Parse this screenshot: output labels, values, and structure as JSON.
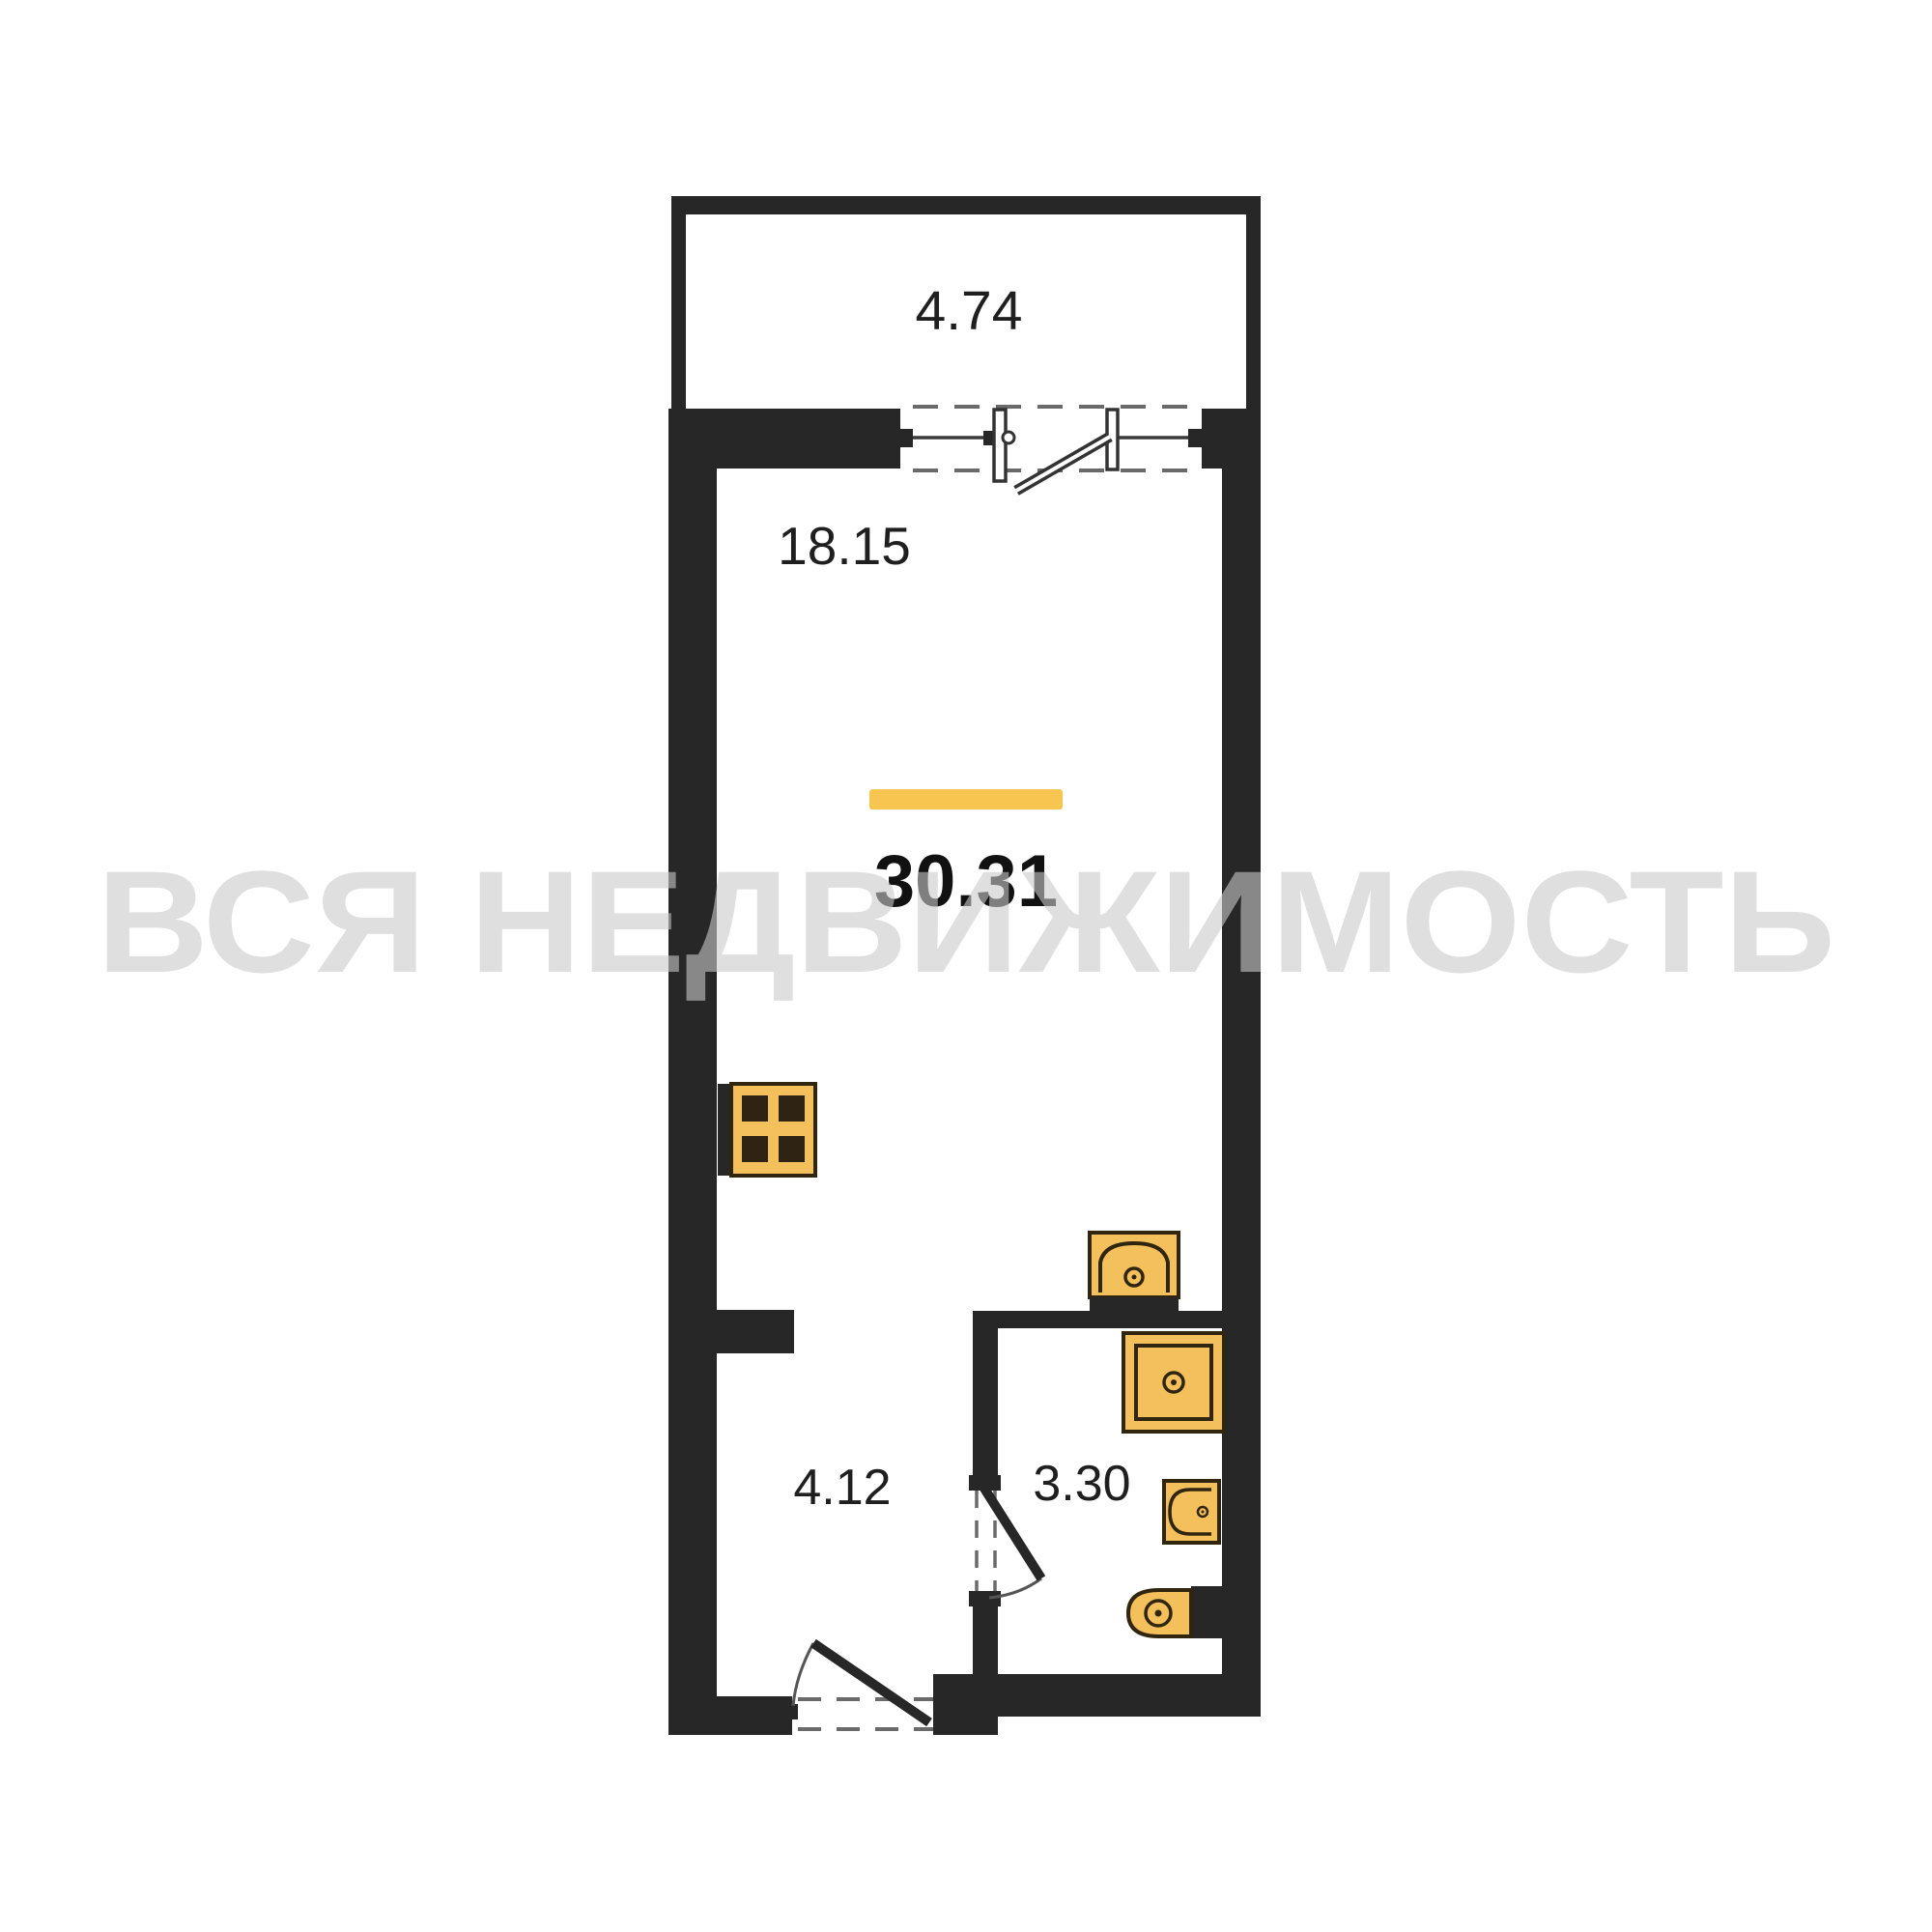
{
  "watermark_text": "ВСЯ НЕДВИЖИМОСТЬ",
  "plan": {
    "total_area_label": "30.31",
    "rooms": {
      "balcony": {
        "area": "4.74"
      },
      "living_room": {
        "area": "18.15"
      },
      "hallway": {
        "area": "4.12"
      },
      "bathroom": {
        "area": "3.30"
      }
    }
  },
  "colors": {
    "wall": "#272727",
    "fixture_fill": "#F4C05B",
    "fixture_stroke": "#30250E",
    "accent_bar": "#F8C550",
    "watermark": "#C9C9C9"
  }
}
